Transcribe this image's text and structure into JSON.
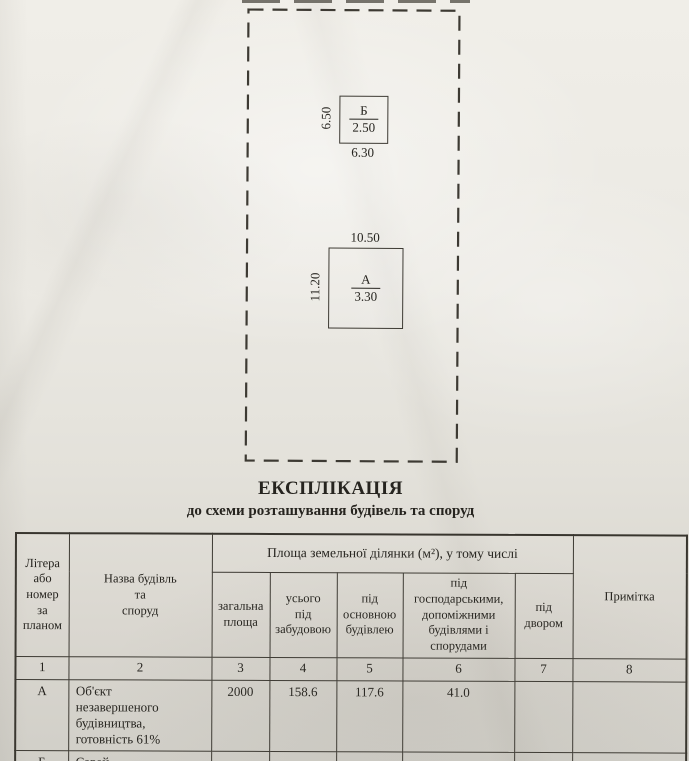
{
  "colors": {
    "paper": "#ebe9e3",
    "ink": "#26241f"
  },
  "site_plan": {
    "buildings": [
      {
        "label": "Б",
        "value": "2.50",
        "left_dim": "6.50",
        "bottom_dim": "6.30"
      },
      {
        "label": "А",
        "value": "3.30",
        "left_dim": "11.20",
        "top_dim": "10.50"
      }
    ]
  },
  "title": {
    "heading": "ЕКСПЛІКАЦІЯ",
    "subheading": "до схеми розташування будівель та споруд"
  },
  "table": {
    "header": {
      "col_letter": "Літера\nабо\nномер\nза\nпланом",
      "col_name": "Назва будівль\nта\nспоруд",
      "area_group": "Площа земельної ділянки (м²), у тому числі",
      "sub": [
        "загальна\nплоща",
        "усього\nпід\nзабудовою",
        "під\nосновною\nбудівлею",
        "під\nгосподарськими,\nдопоміжними\nбудівлями і\nспорудами",
        "під\nдвором"
      ],
      "col_note": "Примітка"
    },
    "number_row": [
      "1",
      "2",
      "3",
      "4",
      "5",
      "6",
      "7",
      "8"
    ],
    "rows": [
      {
        "letter": "А",
        "name": "Об'єкт\nнезавершеного\nбудівництва,\nготовність 61%",
        "cells": [
          "2000",
          "158.6",
          "117.6",
          "41.0",
          "",
          ""
        ]
      },
      {
        "letter": "Б",
        "name": "Сарай",
        "cells": [
          "",
          "",
          "",
          "",
          "",
          ""
        ]
      }
    ]
  }
}
